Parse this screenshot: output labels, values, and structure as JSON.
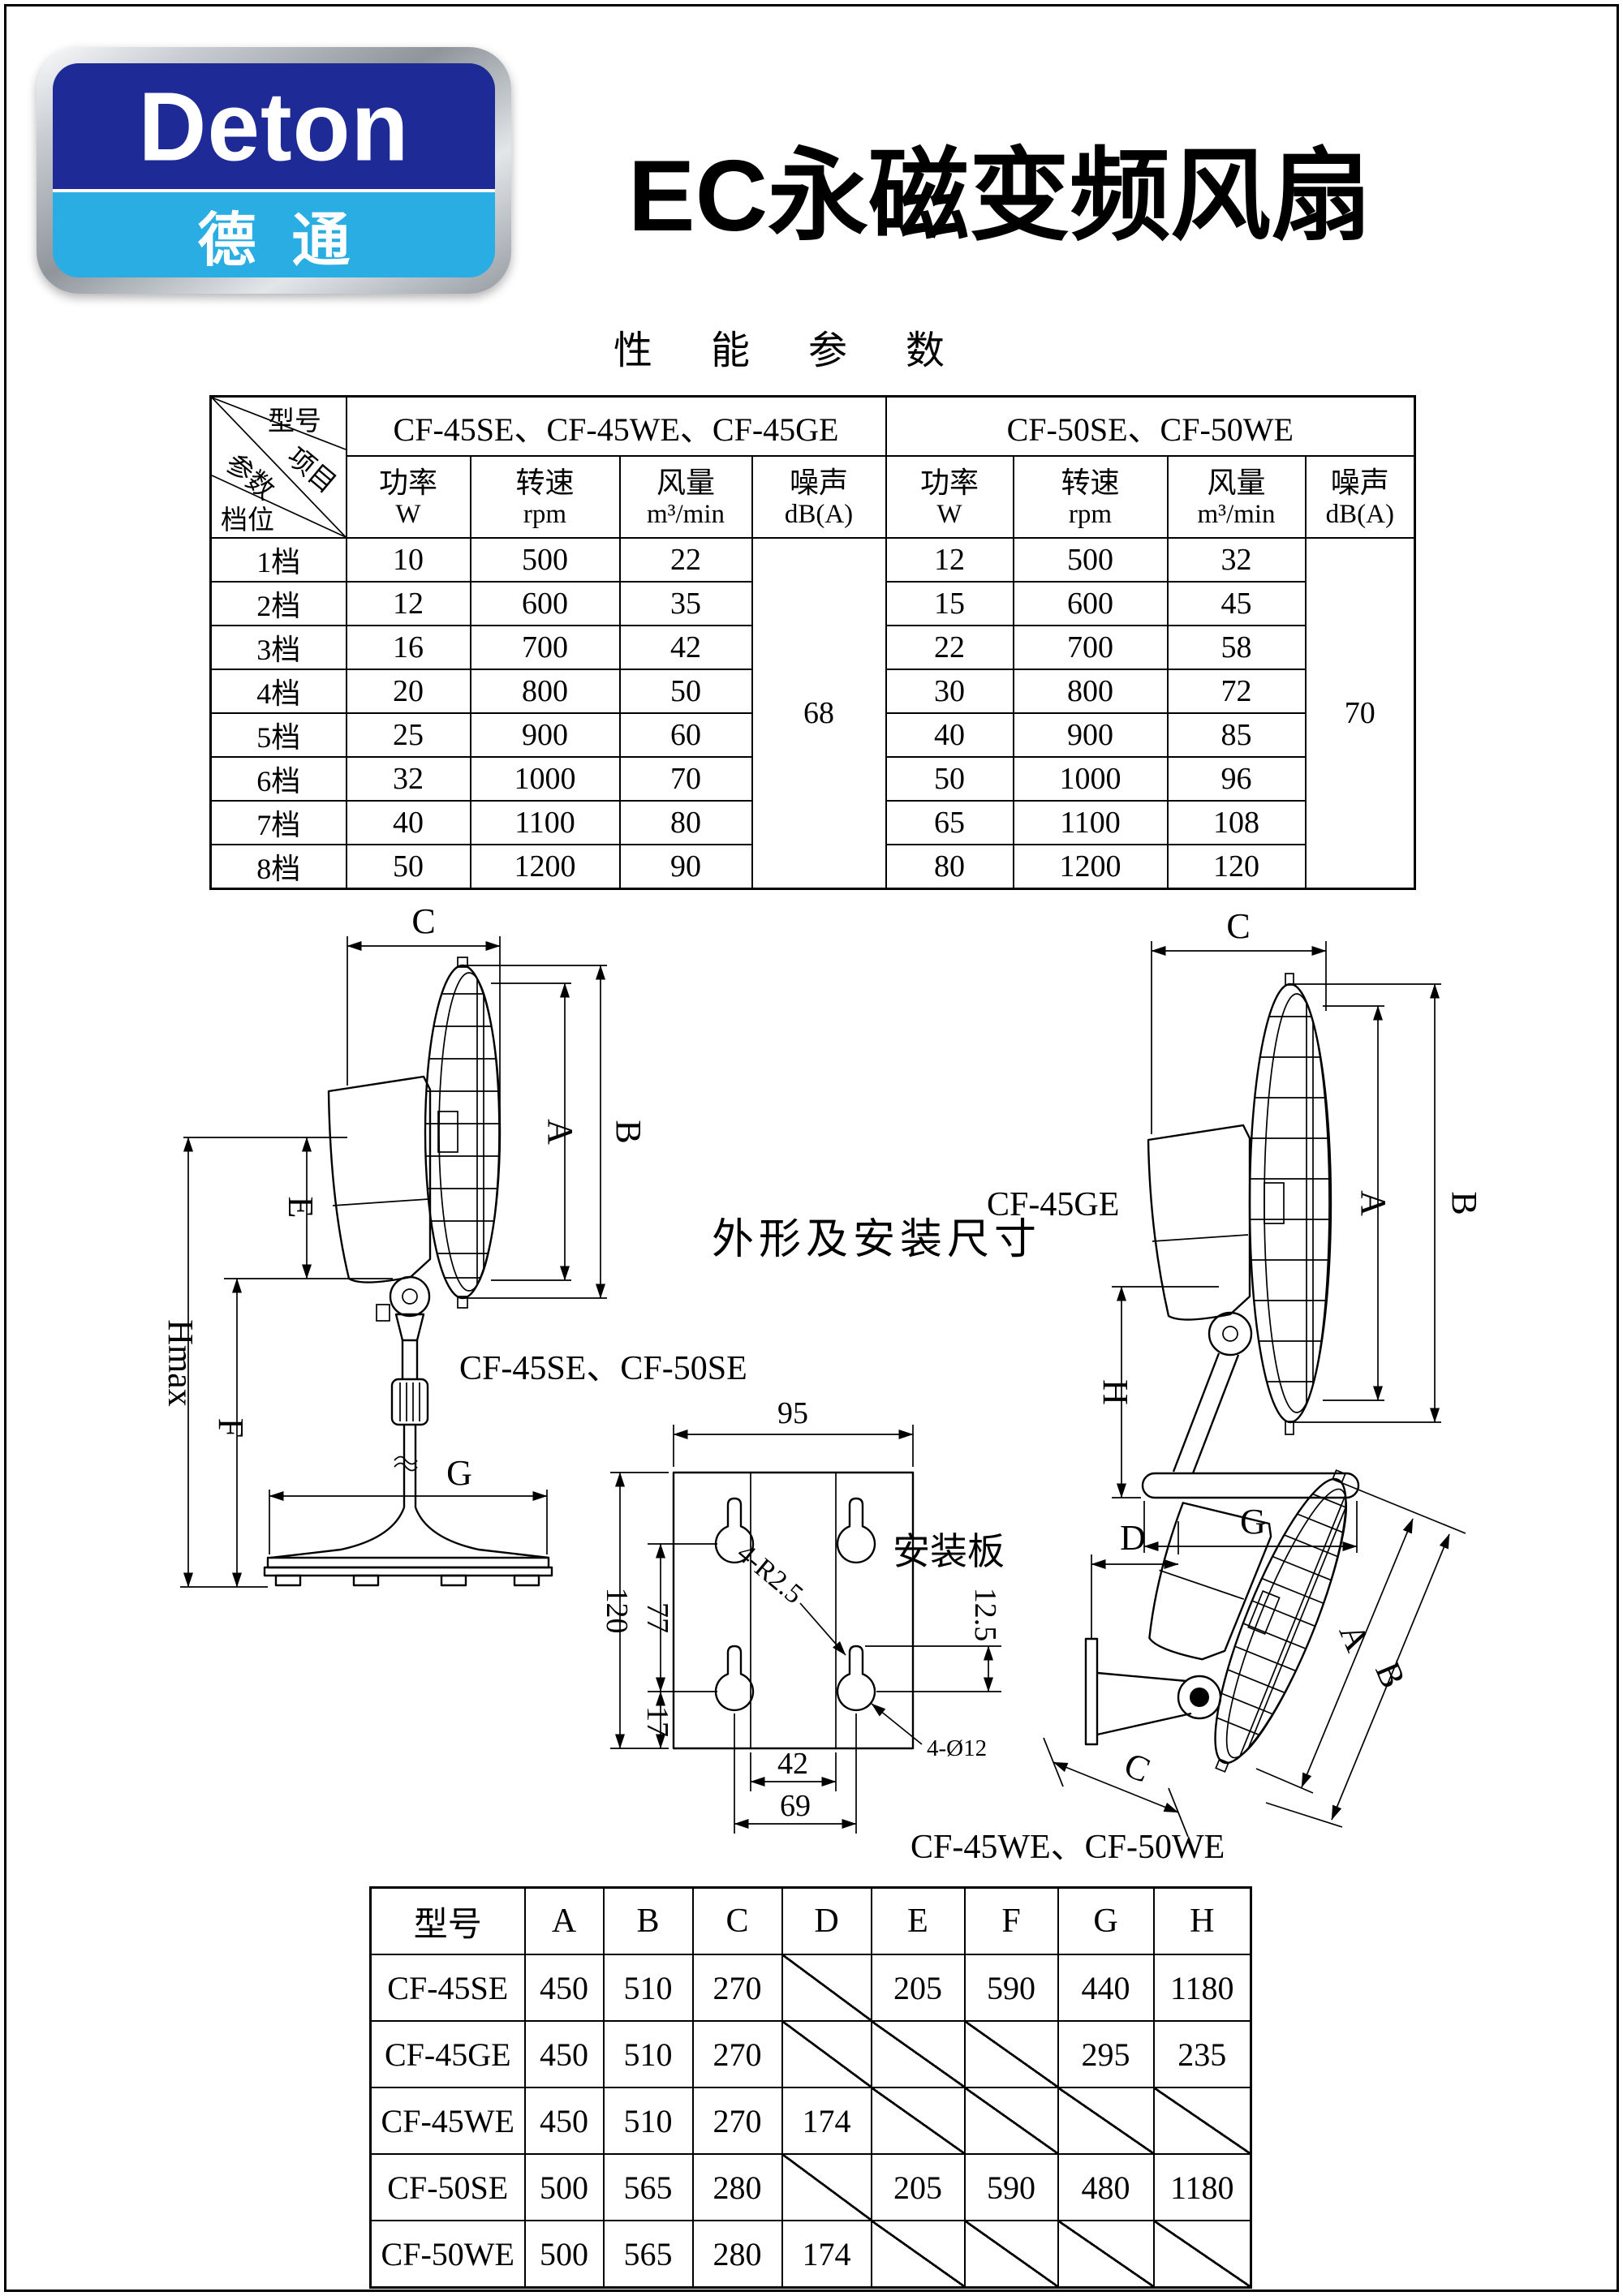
{
  "logo": {
    "brand": "Deton",
    "brand_cn": "德通",
    "dark_blue": "#1e2b96",
    "light_blue": "#29ade3"
  },
  "title": "EC永磁变频风扇",
  "subtitle": "性 能 参 数",
  "perf_table": {
    "corner": {
      "model": "型号",
      "item": "项目",
      "param": "参数",
      "gear": "档位"
    },
    "groups": [
      {
        "models": "CF-45SE、CF-45WE、CF-45GE"
      },
      {
        "models": "CF-50SE、CF-50WE"
      }
    ],
    "subheaders": {
      "power": "功率",
      "power_unit": "W",
      "speed": "转速",
      "speed_unit": "rpm",
      "airflow": "风量",
      "airflow_unit": "m³/min",
      "noise": "噪声",
      "noise_unit": "dB(A)"
    },
    "noise_left": "68",
    "noise_right": "70",
    "rows": [
      {
        "gear": "1档",
        "p1": "10",
        "s1": "500",
        "a1": "22",
        "p2": "12",
        "s2": "500",
        "a2": "32"
      },
      {
        "gear": "2档",
        "p1": "12",
        "s1": "600",
        "a1": "35",
        "p2": "15",
        "s2": "600",
        "a2": "45"
      },
      {
        "gear": "3档",
        "p1": "16",
        "s1": "700",
        "a1": "42",
        "p2": "22",
        "s2": "700",
        "a2": "58"
      },
      {
        "gear": "4档",
        "p1": "20",
        "s1": "800",
        "a1": "50",
        "p2": "30",
        "s2": "800",
        "a2": "72"
      },
      {
        "gear": "5档",
        "p1": "25",
        "s1": "900",
        "a1": "60",
        "p2": "40",
        "s2": "900",
        "a2": "85"
      },
      {
        "gear": "6档",
        "p1": "32",
        "s1": "1000",
        "a1": "70",
        "p2": "50",
        "s2": "1000",
        "a2": "96"
      },
      {
        "gear": "7档",
        "p1": "40",
        "s1": "1100",
        "a1": "80",
        "p2": "65",
        "s2": "1100",
        "a2": "108"
      },
      {
        "gear": "8档",
        "p1": "50",
        "s1": "1200",
        "a1": "90",
        "p2": "80",
        "s2": "1200",
        "a2": "120"
      }
    ]
  },
  "drawings": {
    "heading": "外形及安装尺寸",
    "pedestal": {
      "model_label": "CF-45SE、CF-50SE"
    },
    "desk": {
      "model_label": "CF-45GE"
    },
    "wall": {
      "model_label": "CF-45WE、CF-50WE"
    },
    "plate": {
      "label": "安装板",
      "dims": {
        "width": "95",
        "height": "120",
        "hole_spacing_v": "77",
        "bottom_offset": "17",
        "inner_width": "42",
        "hole_spacing_h": "69",
        "slot_offset": "12.5",
        "corner_radius": "4-R2.5",
        "hole_diameter": "4-Ø12"
      }
    },
    "dim_letters": {
      "A": "A",
      "B": "B",
      "C": "C",
      "D": "D",
      "E": "E",
      "F": "F",
      "G": "G",
      "H": "H",
      "Hmax": "Hmax"
    }
  },
  "dim_table": {
    "headers": [
      "型号",
      "A",
      "B",
      "C",
      "D",
      "E",
      "F",
      "G",
      "H"
    ],
    "rows": [
      {
        "model": "CF-45SE",
        "A": "450",
        "B": "510",
        "C": "270",
        "D": null,
        "E": "205",
        "F": "590",
        "G": "440",
        "H": "1180"
      },
      {
        "model": "CF-45GE",
        "A": "450",
        "B": "510",
        "C": "270",
        "D": null,
        "E": null,
        "F": null,
        "G": "295",
        "H": "235"
      },
      {
        "model": "CF-45WE",
        "A": "450",
        "B": "510",
        "C": "270",
        "D": "174",
        "E": null,
        "F": null,
        "G": null,
        "H": null
      },
      {
        "model": "CF-50SE",
        "A": "500",
        "B": "565",
        "C": "280",
        "D": null,
        "E": "205",
        "F": "590",
        "G": "480",
        "H": "1180"
      },
      {
        "model": "CF-50WE",
        "A": "500",
        "B": "565",
        "C": "280",
        "D": "174",
        "E": null,
        "F": null,
        "G": null,
        "H": null
      }
    ]
  }
}
